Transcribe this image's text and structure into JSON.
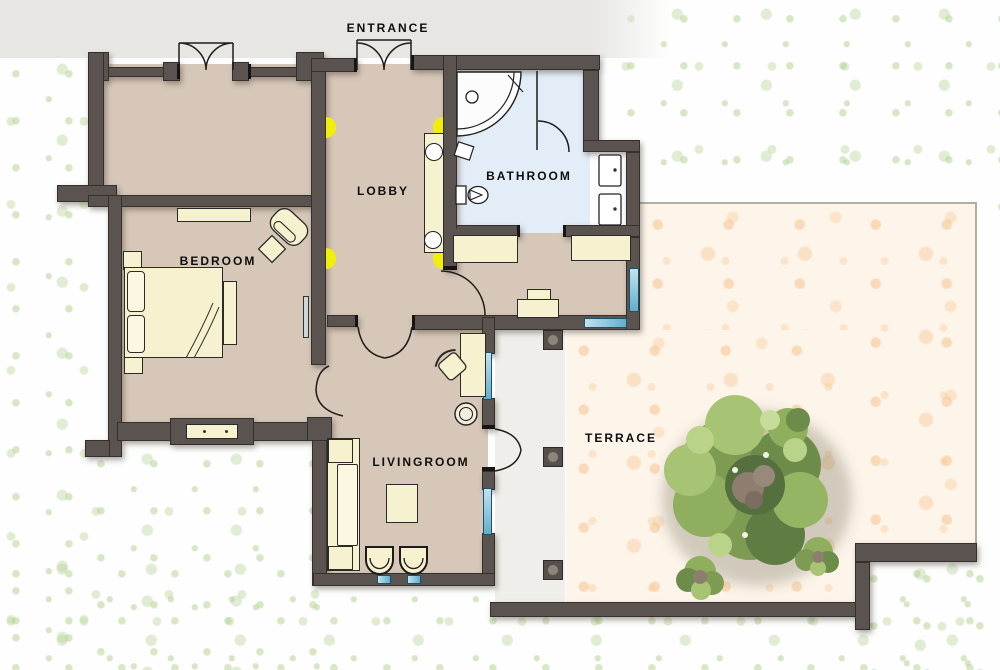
{
  "scene": {
    "type": "apartment floor plan with terrace"
  },
  "rooms": {
    "entrance": {
      "label": "ENTRANCE"
    },
    "lobby": {
      "label": "LOBBY"
    },
    "bathroom": {
      "label": "BATHROOM"
    },
    "bedroom": {
      "label": "BEDROOM"
    },
    "livingroom": {
      "label": "LIVINGROOM"
    },
    "terrace": {
      "label": "TERRACE"
    }
  },
  "colors": {
    "wall": "#5a534f",
    "room_floor": "#d6c7b9",
    "bathroom_floor": "#e3edf7",
    "terrace_paving": "#f9e3cd",
    "walkway": "#f0eeea",
    "grass_accent": "#cfe3b4",
    "driveway_gray": "#e7e6e3",
    "wall_light_yellow": "#f0ee0a",
    "window_blue": "#62aecd",
    "furniture_cream": "#f6f1cf",
    "tree_green": "#7d9b52"
  },
  "features": {
    "wall_lights": "yellow half-disc lamps in lobby",
    "tree": "large round tree on terrace with two small bushes",
    "pillars": "three square pillars along covered walkway"
  }
}
